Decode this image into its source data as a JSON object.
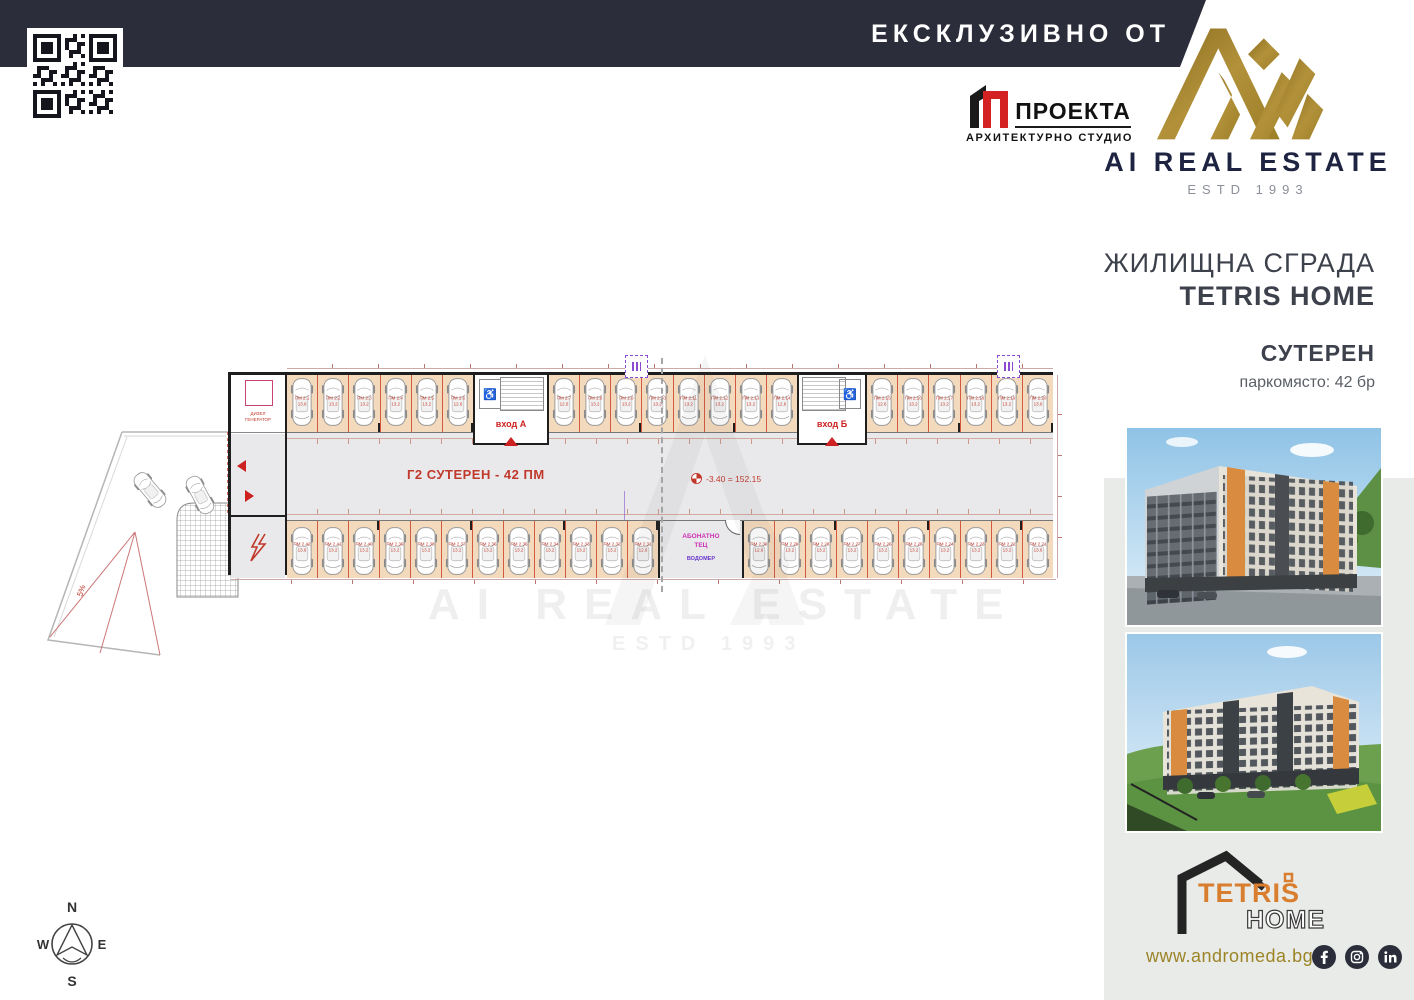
{
  "header": {
    "banner": "ЕКСКЛУЗИВНО ОТ",
    "proekta_name": "ПРОЕКТА",
    "proekta_sub": "АРХИТЕКТУРНО СТУДИО",
    "brand": "AI REAL ESTATE",
    "estd": "ESTD 1993"
  },
  "sidebar": {
    "building_type": "ЖИЛИЩНА СГРАДА",
    "building_name": "TETRIS HOME",
    "floor_label": "СУТЕРЕН",
    "capacity": "паркомясто: 42 бр",
    "website": "www.andromeda.bg",
    "logo_top": "TETRIS",
    "logo_bottom": "HOME",
    "social": [
      "facebook",
      "instagram",
      "linkedin"
    ]
  },
  "watermark": {
    "line1": "AI REAL ESTATE",
    "line2": "ESTD 1993"
  },
  "plan": {
    "title": "Г2  СУТЕРЕН - 42 ПМ",
    "level_marker": "-3.40 = 152.15",
    "entrance_a": "вход А",
    "entrance_b": "вход Б",
    "generator_room_1": "ДИЗЕЛ",
    "generator_room_2": "ГЕНЕРАТОР",
    "tec_room_1": "АБОНАТНО",
    "tec_room_2": "ТЕЦ",
    "tec_room_3": "ВОДОМЕР",
    "slope": "5%",
    "top_group_sizes": [
      6,
      8,
      6
    ],
    "bottom_group_sizes": [
      12,
      10
    ],
    "top_stalls": [
      [
        "ПМ 2.1",
        "13.6"
      ],
      [
        "ПМ 2.2",
        "13.2"
      ],
      [
        "ПМ 2.3",
        "13.2"
      ],
      [
        "ПМ 2.4",
        "13.2"
      ],
      [
        "ПМ 2.5",
        "13.2"
      ],
      [
        "ПМ 2.6",
        "12.6"
      ],
      [
        "ПМ 2.7",
        "12.6"
      ],
      [
        "ПМ 2.8",
        "13.2"
      ],
      [
        "ПМ 2.9",
        "13.2"
      ],
      [
        "ПМ 2.10",
        "13.2"
      ],
      [
        "ПМ 2.11",
        "13.2"
      ],
      [
        "ПМ 2.12",
        "13.2"
      ],
      [
        "ПМ 2.13",
        "13.2"
      ],
      [
        "ПМ 2.14",
        "12.6"
      ],
      [
        "ПМ 2.15",
        "12.6"
      ],
      [
        "ПМ 2.16",
        "13.2"
      ],
      [
        "ПМ 2.17",
        "13.2"
      ],
      [
        "ПМ 2.18",
        "13.2"
      ],
      [
        "ПМ 2.19",
        "13.2"
      ],
      [
        "ПМ 2.20",
        "13.6"
      ]
    ],
    "bottom_stalls": [
      [
        "ПМ 2.42",
        "13.6"
      ],
      [
        "ПМ 2.41",
        "13.2"
      ],
      [
        "ПМ 2.40",
        "13.2"
      ],
      [
        "ПМ 2.39",
        "13.2"
      ],
      [
        "ПМ 2.38",
        "13.2"
      ],
      [
        "ПМ 2.37",
        "13.2"
      ],
      [
        "ПМ 2.36",
        "13.2"
      ],
      [
        "ПМ 2.35",
        "13.2"
      ],
      [
        "ПМ 2.34",
        "13.2"
      ],
      [
        "ПМ 2.33",
        "13.2"
      ],
      [
        "ПМ 2.32",
        "13.2"
      ],
      [
        "ПМ 2.31",
        "12.6"
      ],
      [
        "ПМ 2.30",
        "12.6"
      ],
      [
        "ПМ 2.29",
        "13.2"
      ],
      [
        "ПМ 2.28",
        "13.2"
      ],
      [
        "ПМ 2.27",
        "13.2"
      ],
      [
        "ПМ 2.26",
        "13.2"
      ],
      [
        "ПМ 2.25",
        "13.2"
      ],
      [
        "ПМ 2.24",
        "13.2"
      ],
      [
        "ПМ 2.23",
        "13.2"
      ],
      [
        "ПМ 2.22",
        "13.2"
      ],
      [
        "ПМ 2.21",
        "13.6"
      ]
    ]
  },
  "compass": {
    "n": "N",
    "e": "E",
    "s": "S",
    "w": "W"
  },
  "colors": {
    "navy": "#2b2d3a",
    "gold": "#a8892f",
    "accent_red": "#c0392b",
    "stall_tan": "#f4dabd"
  }
}
